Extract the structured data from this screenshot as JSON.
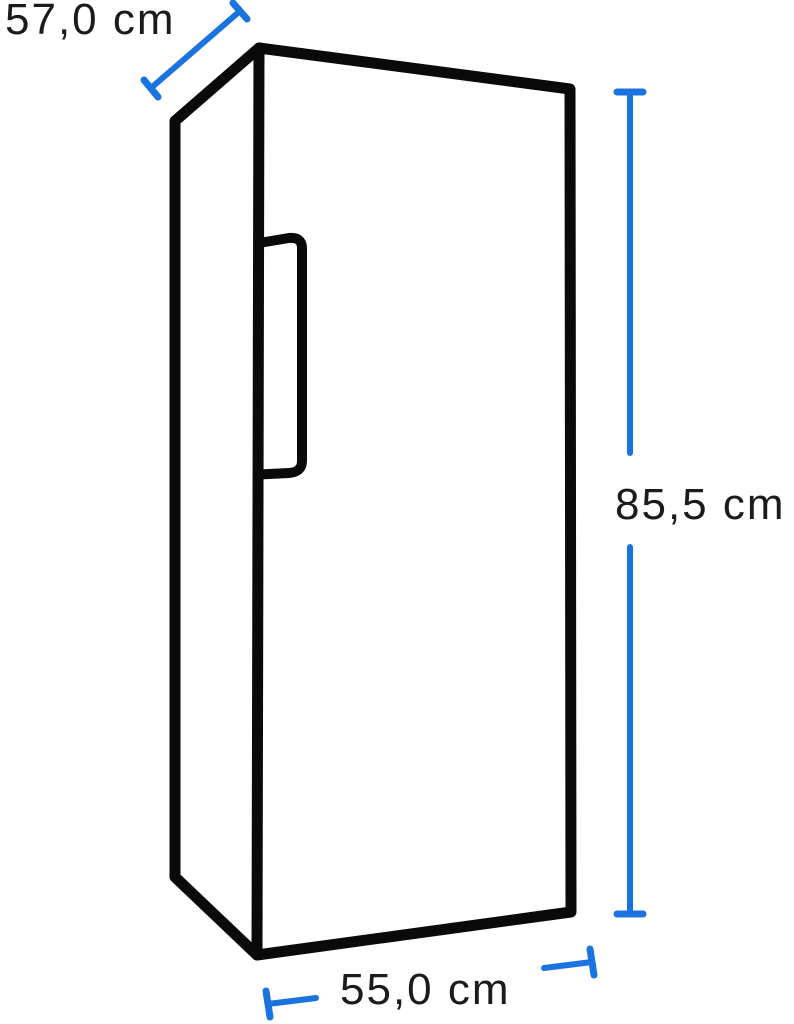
{
  "page": {
    "background": "#ffffff"
  },
  "diagram": {
    "kind": "product-dimension-line-drawing",
    "object": "upright refrigerator with vertical door handle, three-quarter perspective view",
    "dimensions": [
      {
        "id": "depth",
        "label": "57,0 cm",
        "value_cm": 57.0,
        "placement": "diagonal dimension line, top left"
      },
      {
        "id": "height",
        "label": "85,5 cm",
        "value_cm": 85.5,
        "placement": "vertical dimension line, right side"
      },
      {
        "id": "width",
        "label": "55,0 cm",
        "value_cm": 55.0,
        "placement": "slanted horizontal dimension line, bottom"
      }
    ],
    "colors": {
      "outline": "#0a0a0a",
      "dimension_lines": "#1a73de",
      "label_text": "#1b1b1b",
      "background": "#ffffff"
    }
  }
}
